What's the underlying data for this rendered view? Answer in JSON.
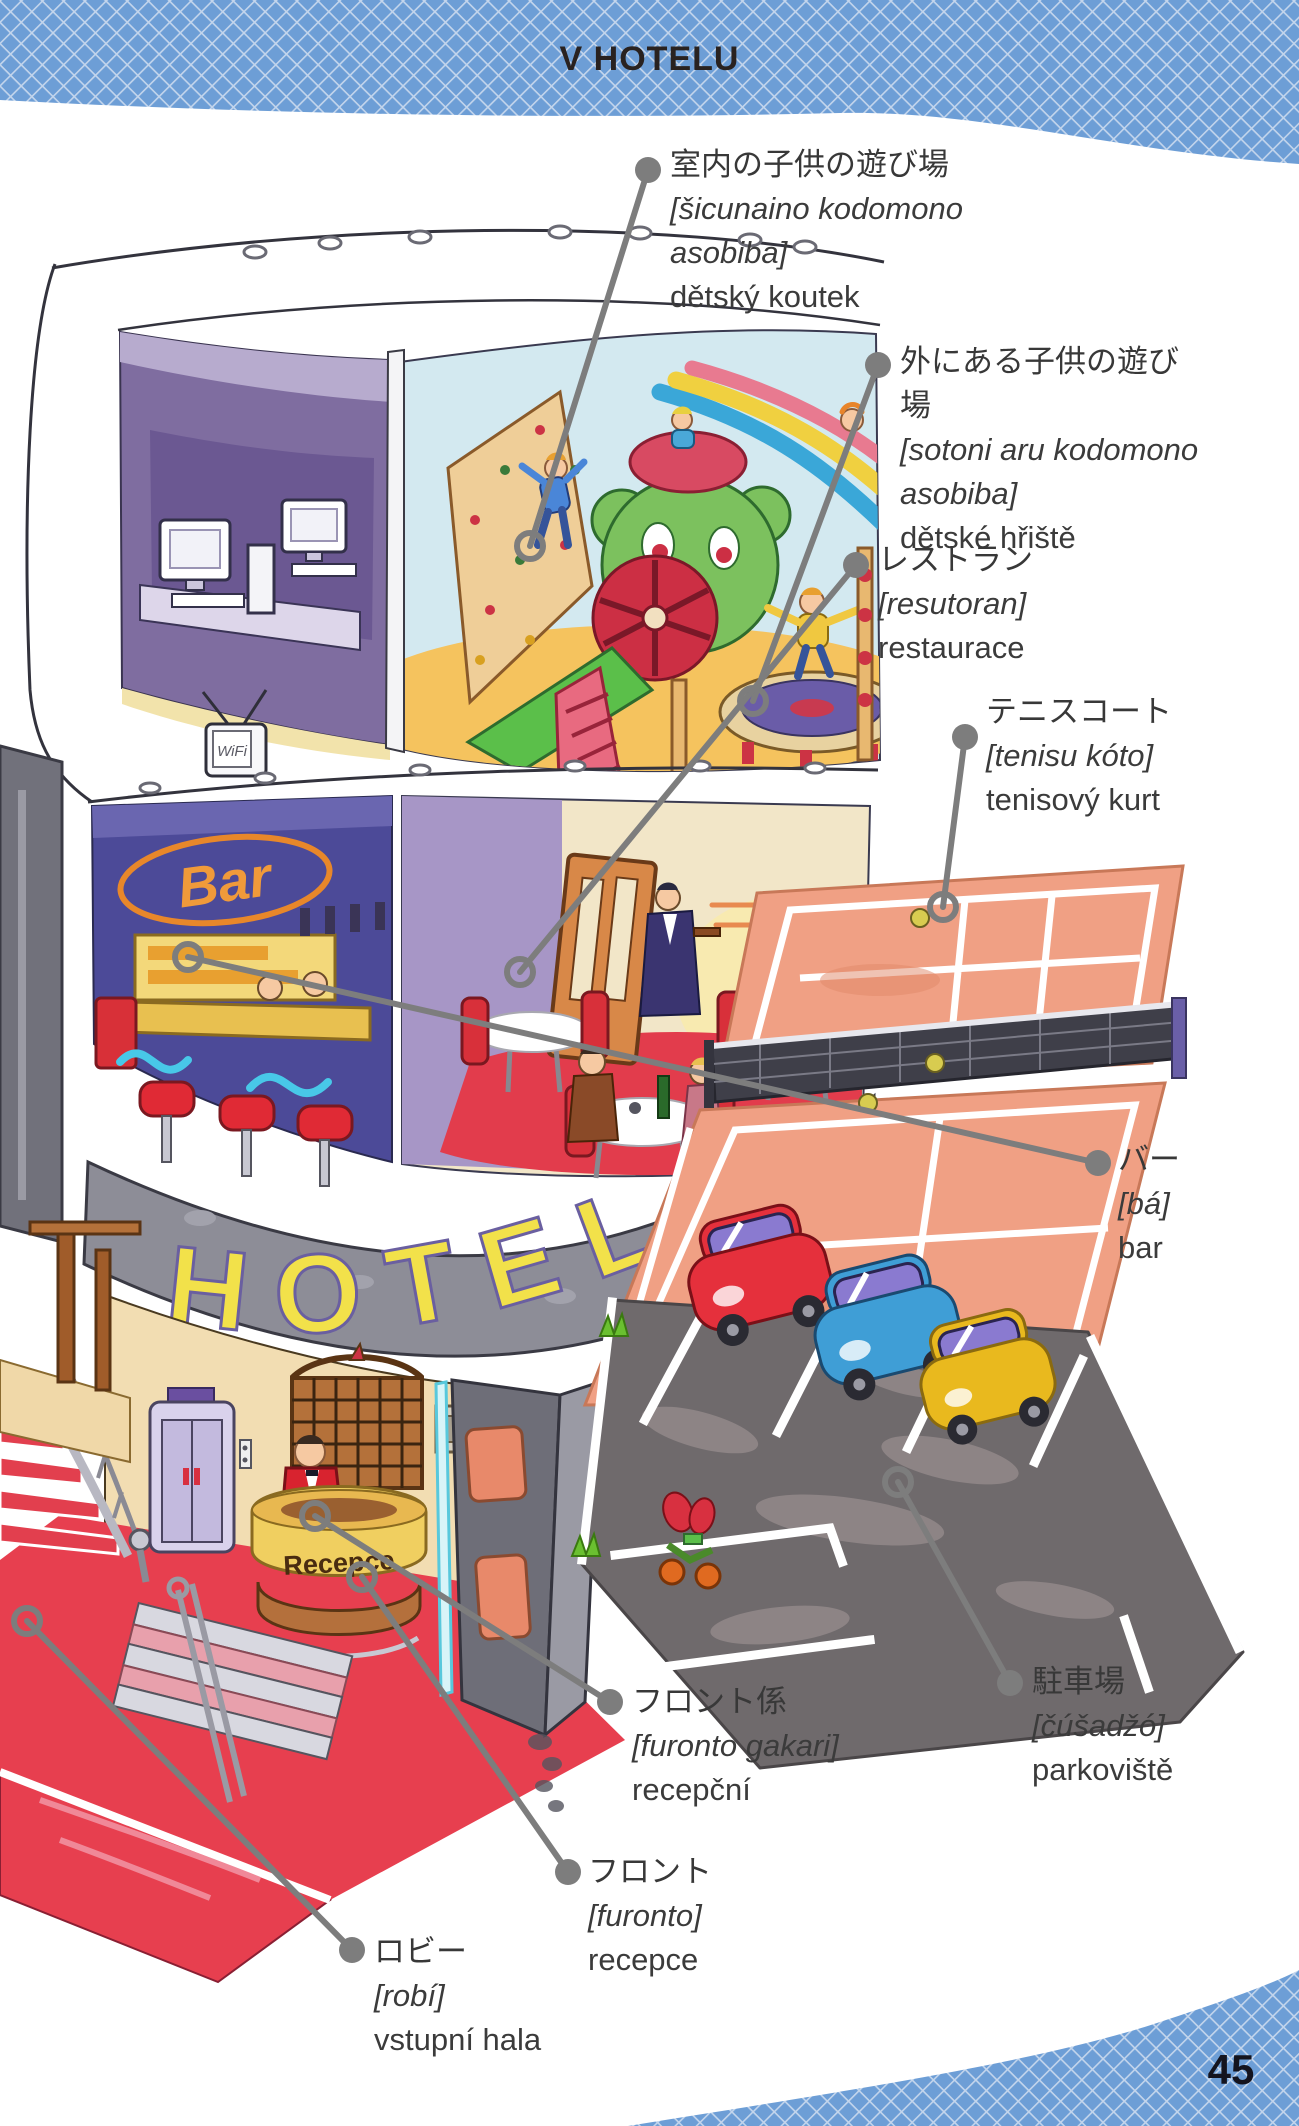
{
  "page": {
    "title": "V HOTELU",
    "page_number": "45"
  },
  "colors": {
    "band_blue": "#6d9ed6",
    "band_lattice": "#c3d5ec",
    "leader_gray": "#7d7d7d",
    "label_text": "#3b3b3b",
    "hotel_sign_yellow": "#f2e14a",
    "carpet_red": "#e73f4f",
    "tennis_clay": "#f0a084",
    "asphalt_gray": "#6f6a6c"
  },
  "illustration": {
    "hotel_sign": "HOTEL",
    "bar_sign": "Bar",
    "reception_desk_sign": "Recepce",
    "tv_text": "WiFi"
  },
  "labels": [
    {
      "id": "indoor-playroom",
      "japanese": "室内の子供の遊び場",
      "pronunciation": "[šicunaino kodomono asobiba]",
      "czech": "dětský koutek"
    },
    {
      "id": "outdoor-playground",
      "japanese": "外にある子供の遊び場",
      "pronunciation": "[sotoni aru kodomono asobiba]",
      "czech": "dětské hřiště"
    },
    {
      "id": "restaurant",
      "japanese": "レストラン",
      "pronunciation": "[resutoran]",
      "czech": "restaurace"
    },
    {
      "id": "tennis-court",
      "japanese": "テニスコート",
      "pronunciation": "[tenisu kóto]",
      "czech": "tenisový kurt"
    },
    {
      "id": "bar",
      "japanese": "バー",
      "pronunciation": "[bá]",
      "czech": "bar"
    },
    {
      "id": "receptionist",
      "japanese": "フロント係",
      "pronunciation": "[furonto gakari]",
      "czech": "recepční"
    },
    {
      "id": "parking-lot",
      "japanese": "駐車場",
      "pronunciation": "[čúšadžó]",
      "czech": "parkoviště"
    },
    {
      "id": "reception-desk",
      "japanese": "フロント",
      "pronunciation": "[furonto]",
      "czech": "recepce"
    },
    {
      "id": "lobby",
      "japanese": "ロビー",
      "pronunciation": "[robí]",
      "czech": "vstupní hala"
    }
  ]
}
